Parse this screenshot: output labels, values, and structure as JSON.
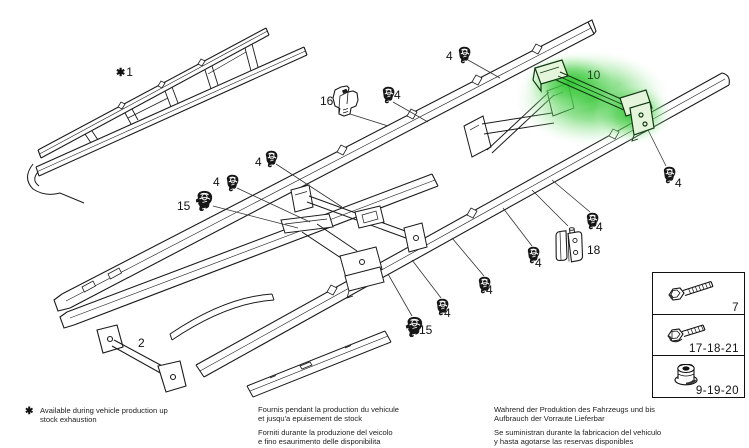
{
  "diagram": {
    "highlighted_part": "10",
    "highlight_color": "#2fbf2f",
    "line_color": "#1a1a1a"
  },
  "callouts": {
    "frame_symbol": "✱",
    "frame_number": "1",
    "part2": "2",
    "part10": "10",
    "part15_left": "15",
    "part15_bottom": "15",
    "part16": "16",
    "part18": "18",
    "clip4_top": "4",
    "clip4_upper_mid": "4",
    "clip4_left_a": "4",
    "clip4_left_b": "4",
    "clip4_right_of_10": "4",
    "clip4_mid_right": "4",
    "clip4_lower_a": "4",
    "clip4_lower_b": "4",
    "clip4_lower_c": "4"
  },
  "legend": {
    "rows": [
      {
        "icon": "hex-bolt-icon",
        "label": "7"
      },
      {
        "icon": "flange-bolt-icon",
        "label": "17-18-21"
      },
      {
        "icon": "flange-nut-icon",
        "label": "9-19-20"
      }
    ]
  },
  "footnotes": {
    "symbol": "✱",
    "en_line1": "Available during vehicle production up",
    "en_line2": "stock exhaustion",
    "fr_line1": "Fournis pendant la production du vehicule",
    "fr_line2": "et jusqu'a epuisement de stock",
    "it_line1": "Forniti durante la produzione del veicolo",
    "it_line2": "e fino esaurimento delle disponibilita",
    "de_line1": "Wahrend der Produktion des Fahrzeugs und bis",
    "de_line2": "Aufbrauch der Vorraute Lieferbar",
    "es_line1": "Se suministran durante la fabricacion del vehiculo",
    "es_line2": "y hasta agotarse las reservas disponibles"
  }
}
